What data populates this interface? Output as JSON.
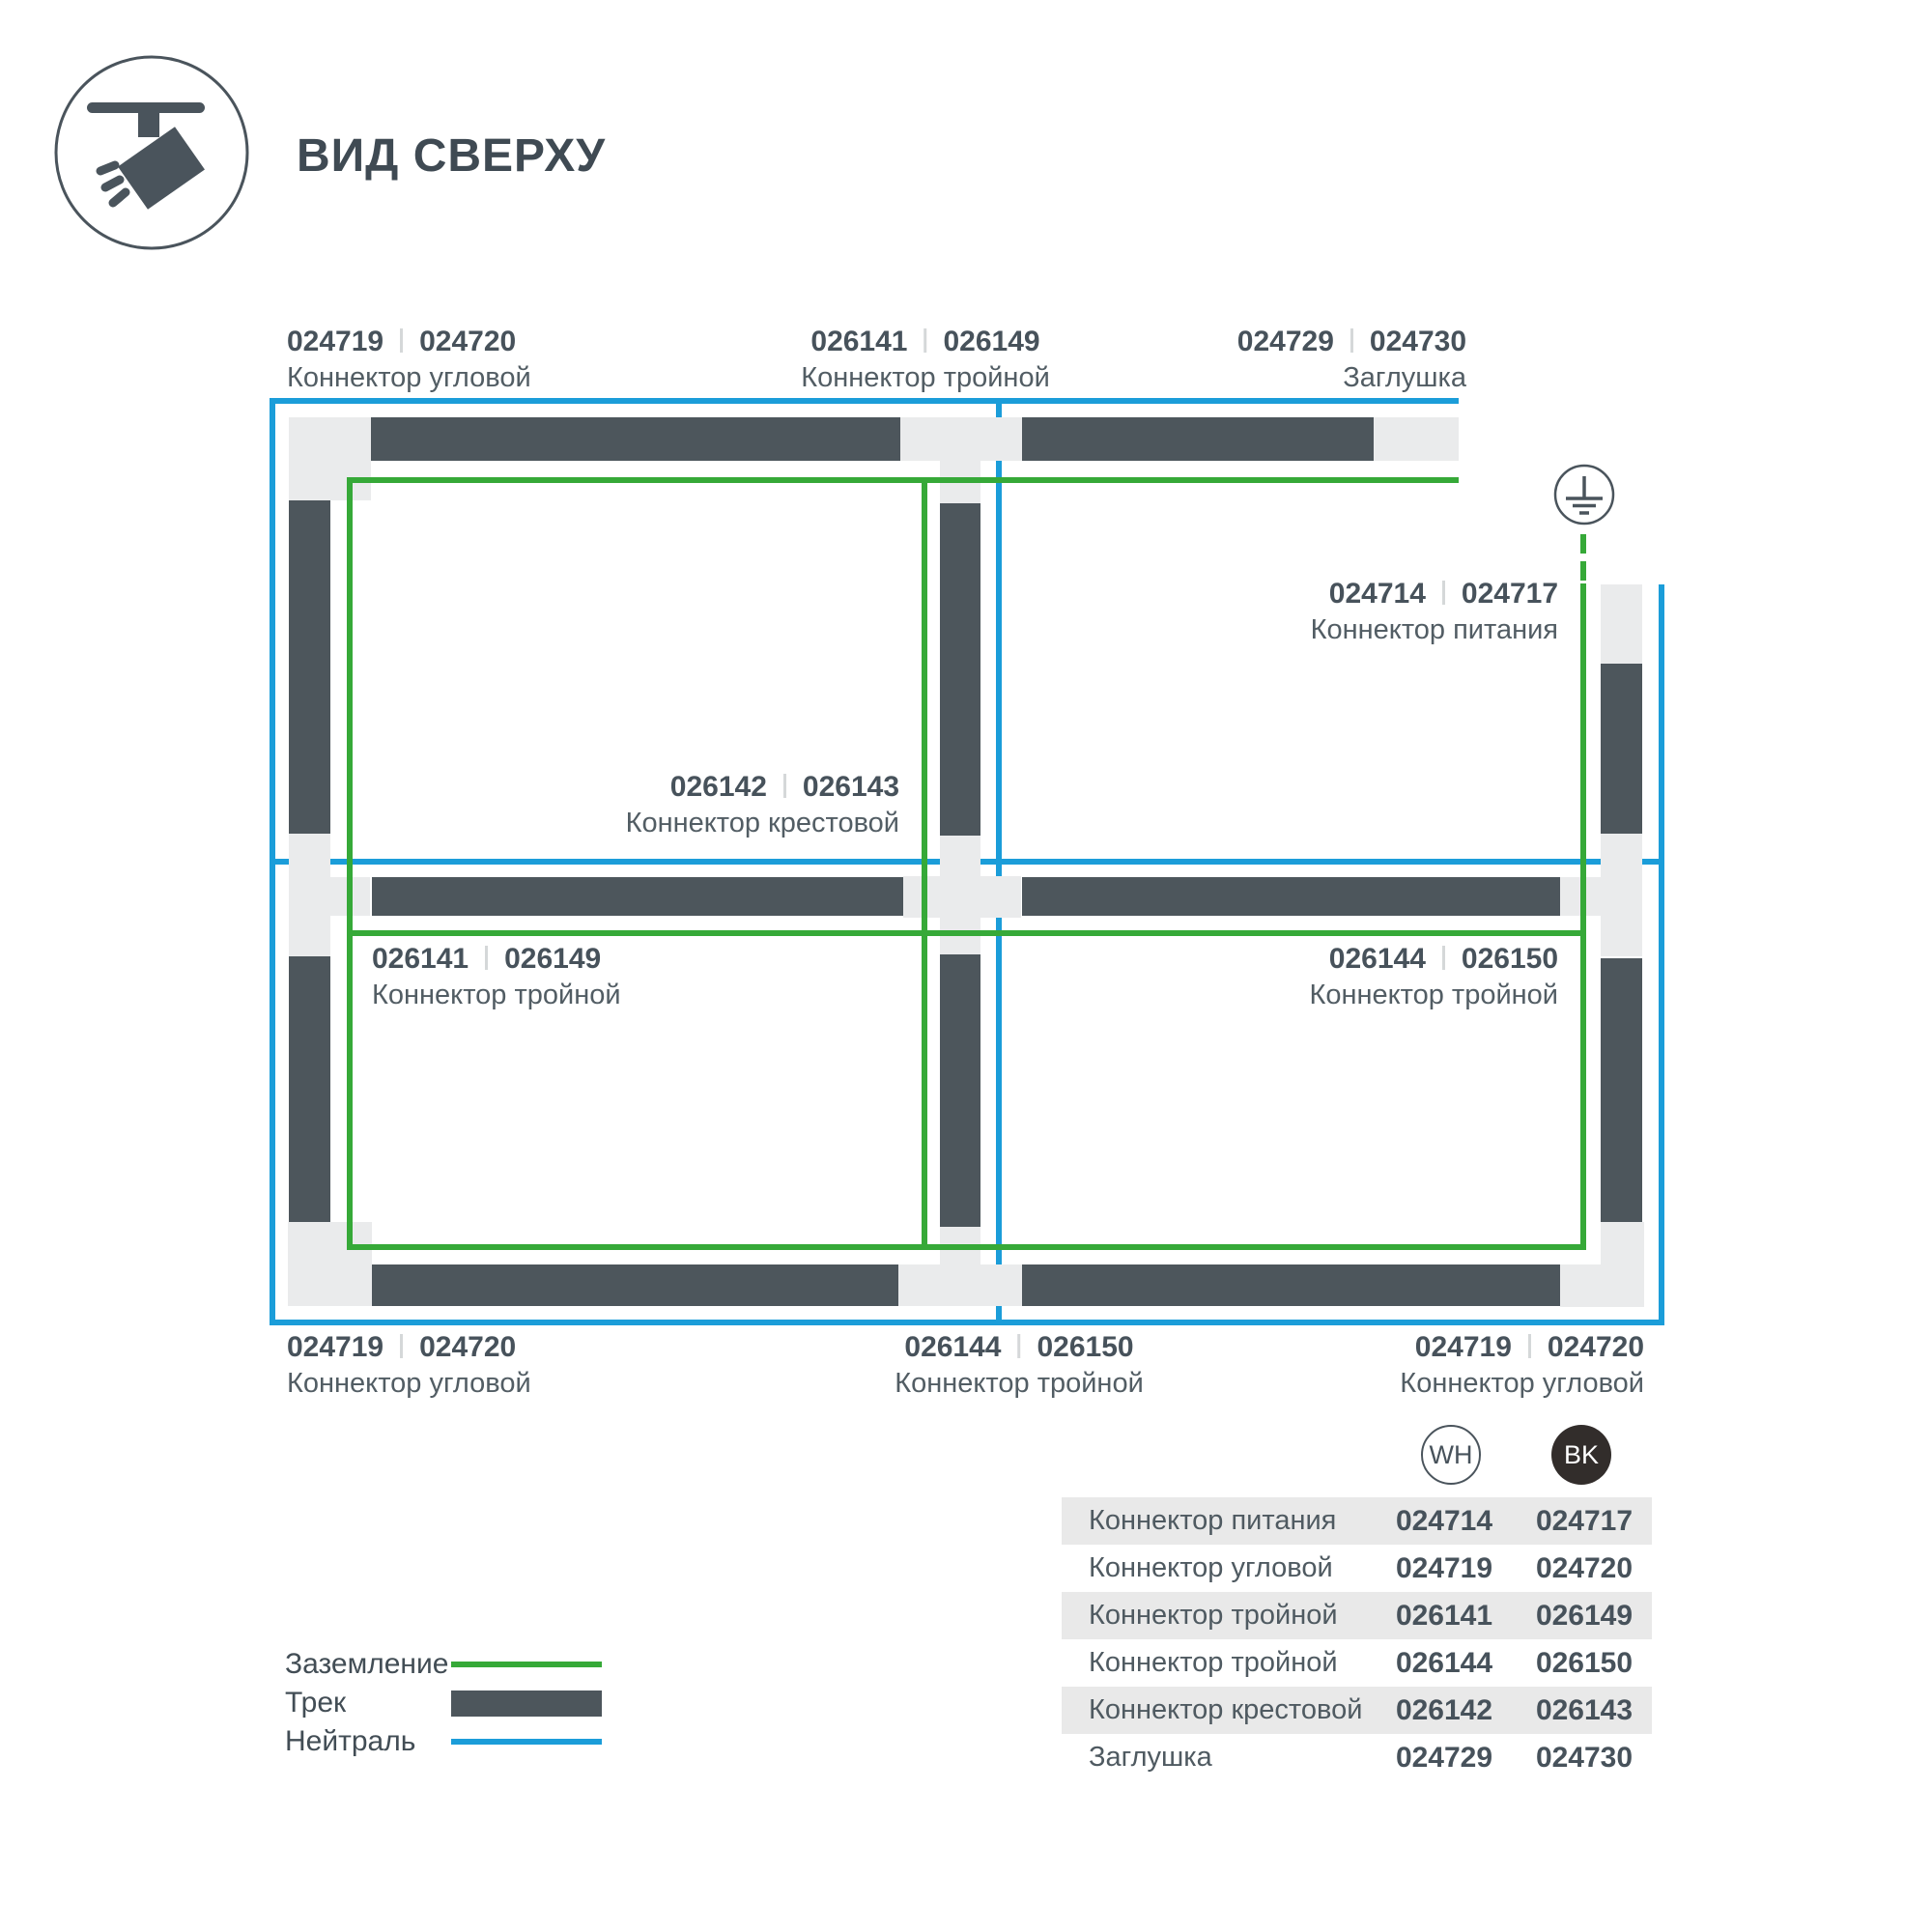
{
  "header": {
    "title": "ВИД СВЕРХУ",
    "icon": "track-spotlight-icon"
  },
  "colors": {
    "track": "#4d565c",
    "connector": "#eaebec",
    "ground_green": "#36a938",
    "neutral_blue": "#1b9dd9",
    "text_dark": "#47525b",
    "text_gray": "#525d64",
    "bk_badge": "#322d2b",
    "table_shade": "#e9e9e9"
  },
  "diagram": {
    "ground_symbol": "earth-ground-icon",
    "labels": [
      {
        "num_wh": "024719",
        "num_bk": "024720",
        "name": "Коннектор угловой"
      },
      {
        "num_wh": "026141",
        "num_bk": "026149",
        "name": "Коннектор тройной"
      },
      {
        "num_wh": "024729",
        "num_bk": "024730",
        "name": "Заглушка"
      },
      {
        "num_wh": "024714",
        "num_bk": "024717",
        "name": "Коннектор питания"
      },
      {
        "num_wh": "026142",
        "num_bk": "026143",
        "name": "Коннектор крестовой"
      },
      {
        "num_wh": "026141",
        "num_bk": "026149",
        "name": "Коннектор тройной"
      },
      {
        "num_wh": "026144",
        "num_bk": "026150",
        "name": "Коннектор тройной"
      },
      {
        "num_wh": "024719",
        "num_bk": "024720",
        "name": "Коннектор угловой"
      },
      {
        "num_wh": "026144",
        "num_bk": "026150",
        "name": "Коннектор тройной"
      },
      {
        "num_wh": "024719",
        "num_bk": "024720",
        "name": "Коннектор угловой"
      }
    ]
  },
  "swatches": {
    "wh": "WH",
    "bk": "BK"
  },
  "table": {
    "rows": [
      {
        "name": "Коннектор питания",
        "wh": "024714",
        "bk": "024717"
      },
      {
        "name": "Коннектор угловой",
        "wh": "024719",
        "bk": "024720"
      },
      {
        "name": "Коннектор тройной",
        "wh": "026141",
        "bk": "026149"
      },
      {
        "name": "Коннектор тройной",
        "wh": "026144",
        "bk": "026150"
      },
      {
        "name": "Коннектор крестовой",
        "wh": "026142",
        "bk": "026143"
      },
      {
        "name": "Заглушка",
        "wh": "024729",
        "bk": "024730"
      }
    ]
  },
  "legend": {
    "items": [
      {
        "label": "Заземление",
        "type": "ground-line"
      },
      {
        "label": "Трек",
        "type": "track-bar"
      },
      {
        "label": "Нейтраль",
        "type": "neutral-line"
      }
    ]
  }
}
